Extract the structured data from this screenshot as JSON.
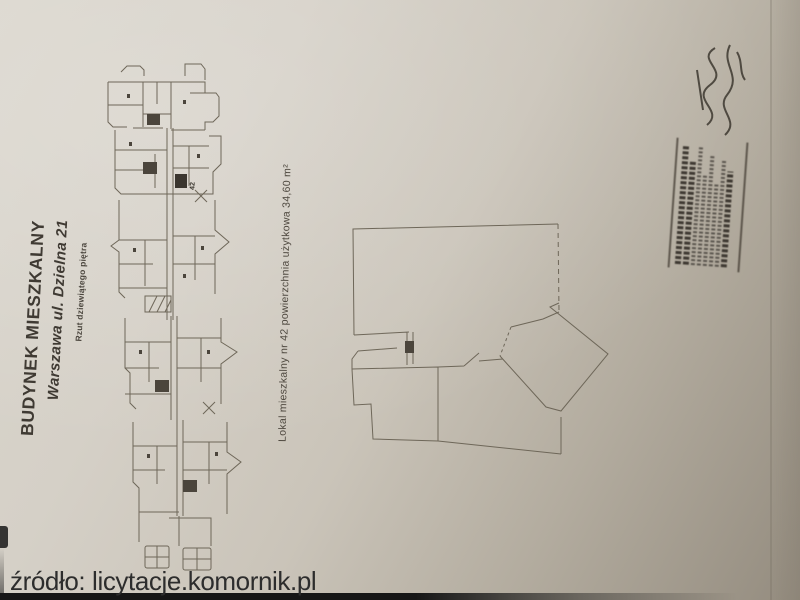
{
  "photo": {
    "watermark_text": "źródło: licytacje.komornik.pl"
  },
  "document": {
    "title_block": {
      "building": "BUDYNEK MIESZKALNY",
      "address": "Warszawa ul. Dzielna 21",
      "subtitle": "Rzut dziewiątego piętra"
    },
    "unit_caption": "Lokal mieszkalny nr 42  powierzchnia użytkowa 34,60 m²",
    "building_plan": {
      "unit_marker": "42"
    },
    "apartment_plan": {
      "rooms": [
        {
          "label": "pokój"
        },
        {
          "label": "przedpokój"
        },
        {
          "label": "kuchnia"
        },
        {
          "label": "pokój"
        }
      ]
    },
    "stamp": {
      "icon": "surveyor-stamp-icon"
    },
    "signature": {
      "icon": "handwritten-signature-icon"
    },
    "colors": {
      "paper": "#d6d1c8",
      "plan_ink": "#6e6759",
      "watermark_ink": "#2d2d2d"
    }
  }
}
